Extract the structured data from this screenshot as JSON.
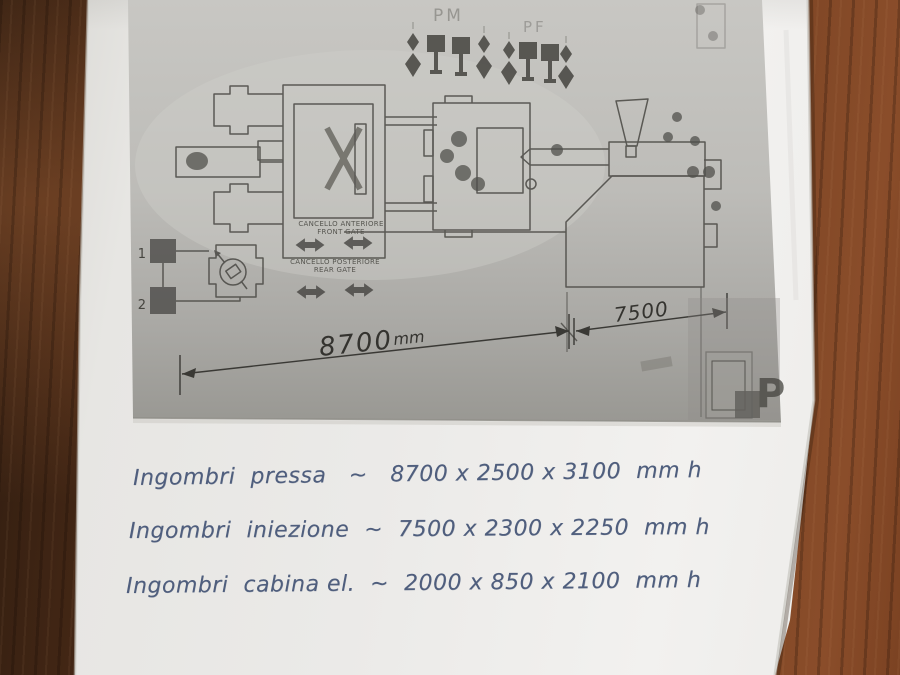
{
  "diagram": {
    "pm_label": "PM",
    "pf_label": "PF",
    "front_gate_label_it": "CANCELLO ANTERIORE",
    "front_gate_label_en": "FRONT GATE",
    "rear_gate_label_it": "CANCELLO POSTERIORE",
    "rear_gate_label_en": "REAR GATE",
    "marker_1": "1",
    "marker_2": "2",
    "corner_mark": "P",
    "dimensions": {
      "press_length": {
        "value": "8700",
        "unit": "mm"
      },
      "injection_length": {
        "value": "7500"
      }
    }
  },
  "notes": [
    {
      "text": "Ingombri  pressa   ~   8700 x 2500 x 3100  mm h"
    },
    {
      "text": "Ingombri  iniezione  ~  7500 x 2300 x 2250  mm h"
    },
    {
      "text": "Ingombri  cabina el.  ~  2000 x 850 x 2100  mm h"
    }
  ],
  "icons": {
    "connector_pin": "stacked-diamond-pin",
    "connector_flag": "square-flag-pin",
    "gate_double_arrow": "left-right-solid-arrow",
    "pump_gauge": "circle-with-tilted-square",
    "hopper": "funnel"
  },
  "colors": {
    "desk_wood": "#6b3a20",
    "paper": "#edecea",
    "photocopy_gray": "#b3b2ae",
    "line_work": "#4e4d49",
    "pencil": "#34332f",
    "pen_ink": "#4f5e7d"
  }
}
